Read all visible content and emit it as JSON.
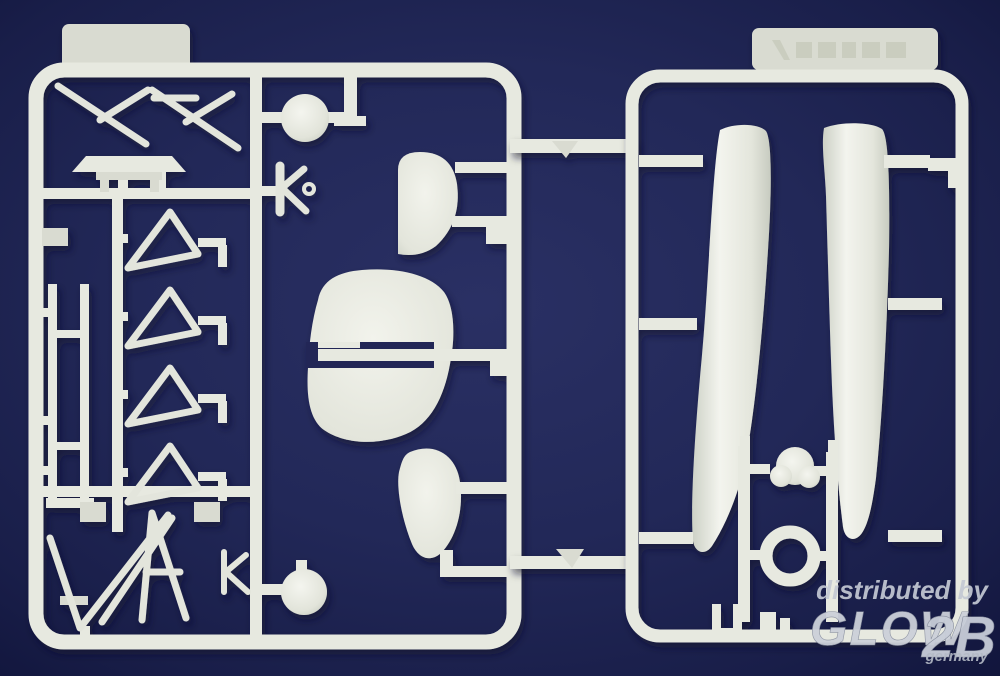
{
  "meta": {
    "type": "product-photo",
    "subject": "injection-molded plastic model kit sprues (white styrene) photographed on dark navy background",
    "sprue_count": 2
  },
  "colors": {
    "background": "#212759",
    "background_edge": "#10143a",
    "plastic": "#e7e9e0",
    "plastic_shadow": "#c3c7bf",
    "cast_shadow": "#0a0e2e",
    "watermark_text": "#c6cbd5"
  },
  "watermark": {
    "prefix": "distributed by",
    "brand": "GLOW",
    "brand_suffix": "2B",
    "country": "germany"
  },
  "left_sprue": {
    "tab": "blank mold tab",
    "parts": [
      "crossed cabane struts",
      "wing spreader bar",
      "paired interplane struts",
      "triangular rib brace x4",
      "cowl disc (top)",
      "K-shaped bracket with ring",
      "quarter-round fin",
      "rounded tail fin with slot",
      "slot rod",
      "teardrop fairing",
      "V landing-gear struts",
      "small K bracket",
      "wheel disc (bottom)"
    ]
  },
  "right_sprue": {
    "tab": "embossed mold stamp (illegible)",
    "parts": [
      "float half left",
      "float half right",
      "engine block",
      "cowl ring",
      "U bracket",
      "mounting blocks"
    ]
  },
  "connectors": {
    "top": "runner bridge with wedge part",
    "bottom": "runner bridge with wedge part"
  }
}
